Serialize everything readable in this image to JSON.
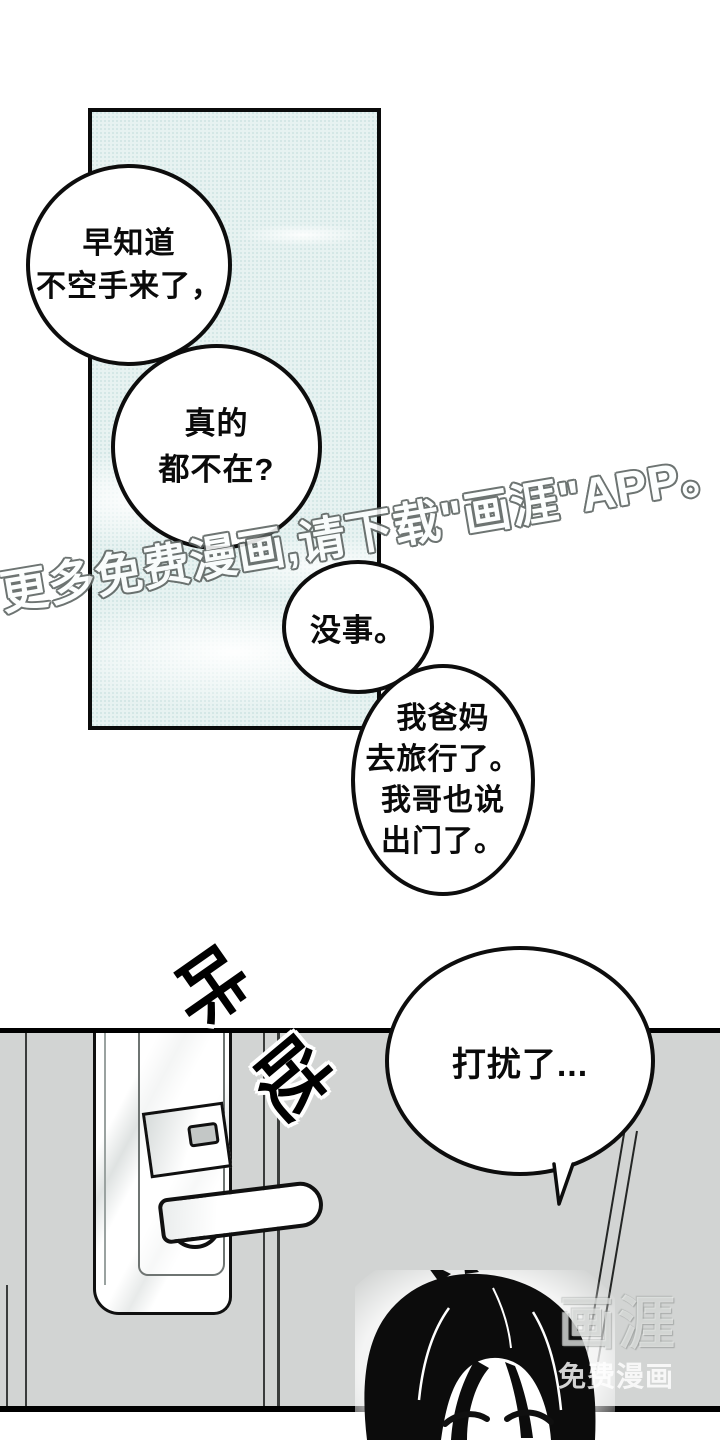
{
  "comic": {
    "bubbles": [
      {
        "lines": [
          "早知道",
          "不空手来了，"
        ]
      },
      {
        "lines": [
          "真的",
          "都不在?"
        ]
      },
      {
        "lines": [
          "没事。"
        ]
      },
      {
        "lines": [
          "我爸妈",
          "去旅行了。",
          "我哥也说",
          "出门了。"
        ]
      },
      {
        "lines": [
          "打扰了..."
        ]
      }
    ],
    "sfx": [
      {
        "char": "咔"
      },
      {
        "char": "哒"
      }
    ],
    "watermarks": {
      "diagonal": "更多免费漫画,请下载\"画涯\"APP。",
      "corner_title": "画涯",
      "corner_subtitle": "免费漫画"
    },
    "colors": {
      "sky": "#e7f2f1",
      "door": "#d2d4d3",
      "ink": "#0d0d0d"
    }
  }
}
